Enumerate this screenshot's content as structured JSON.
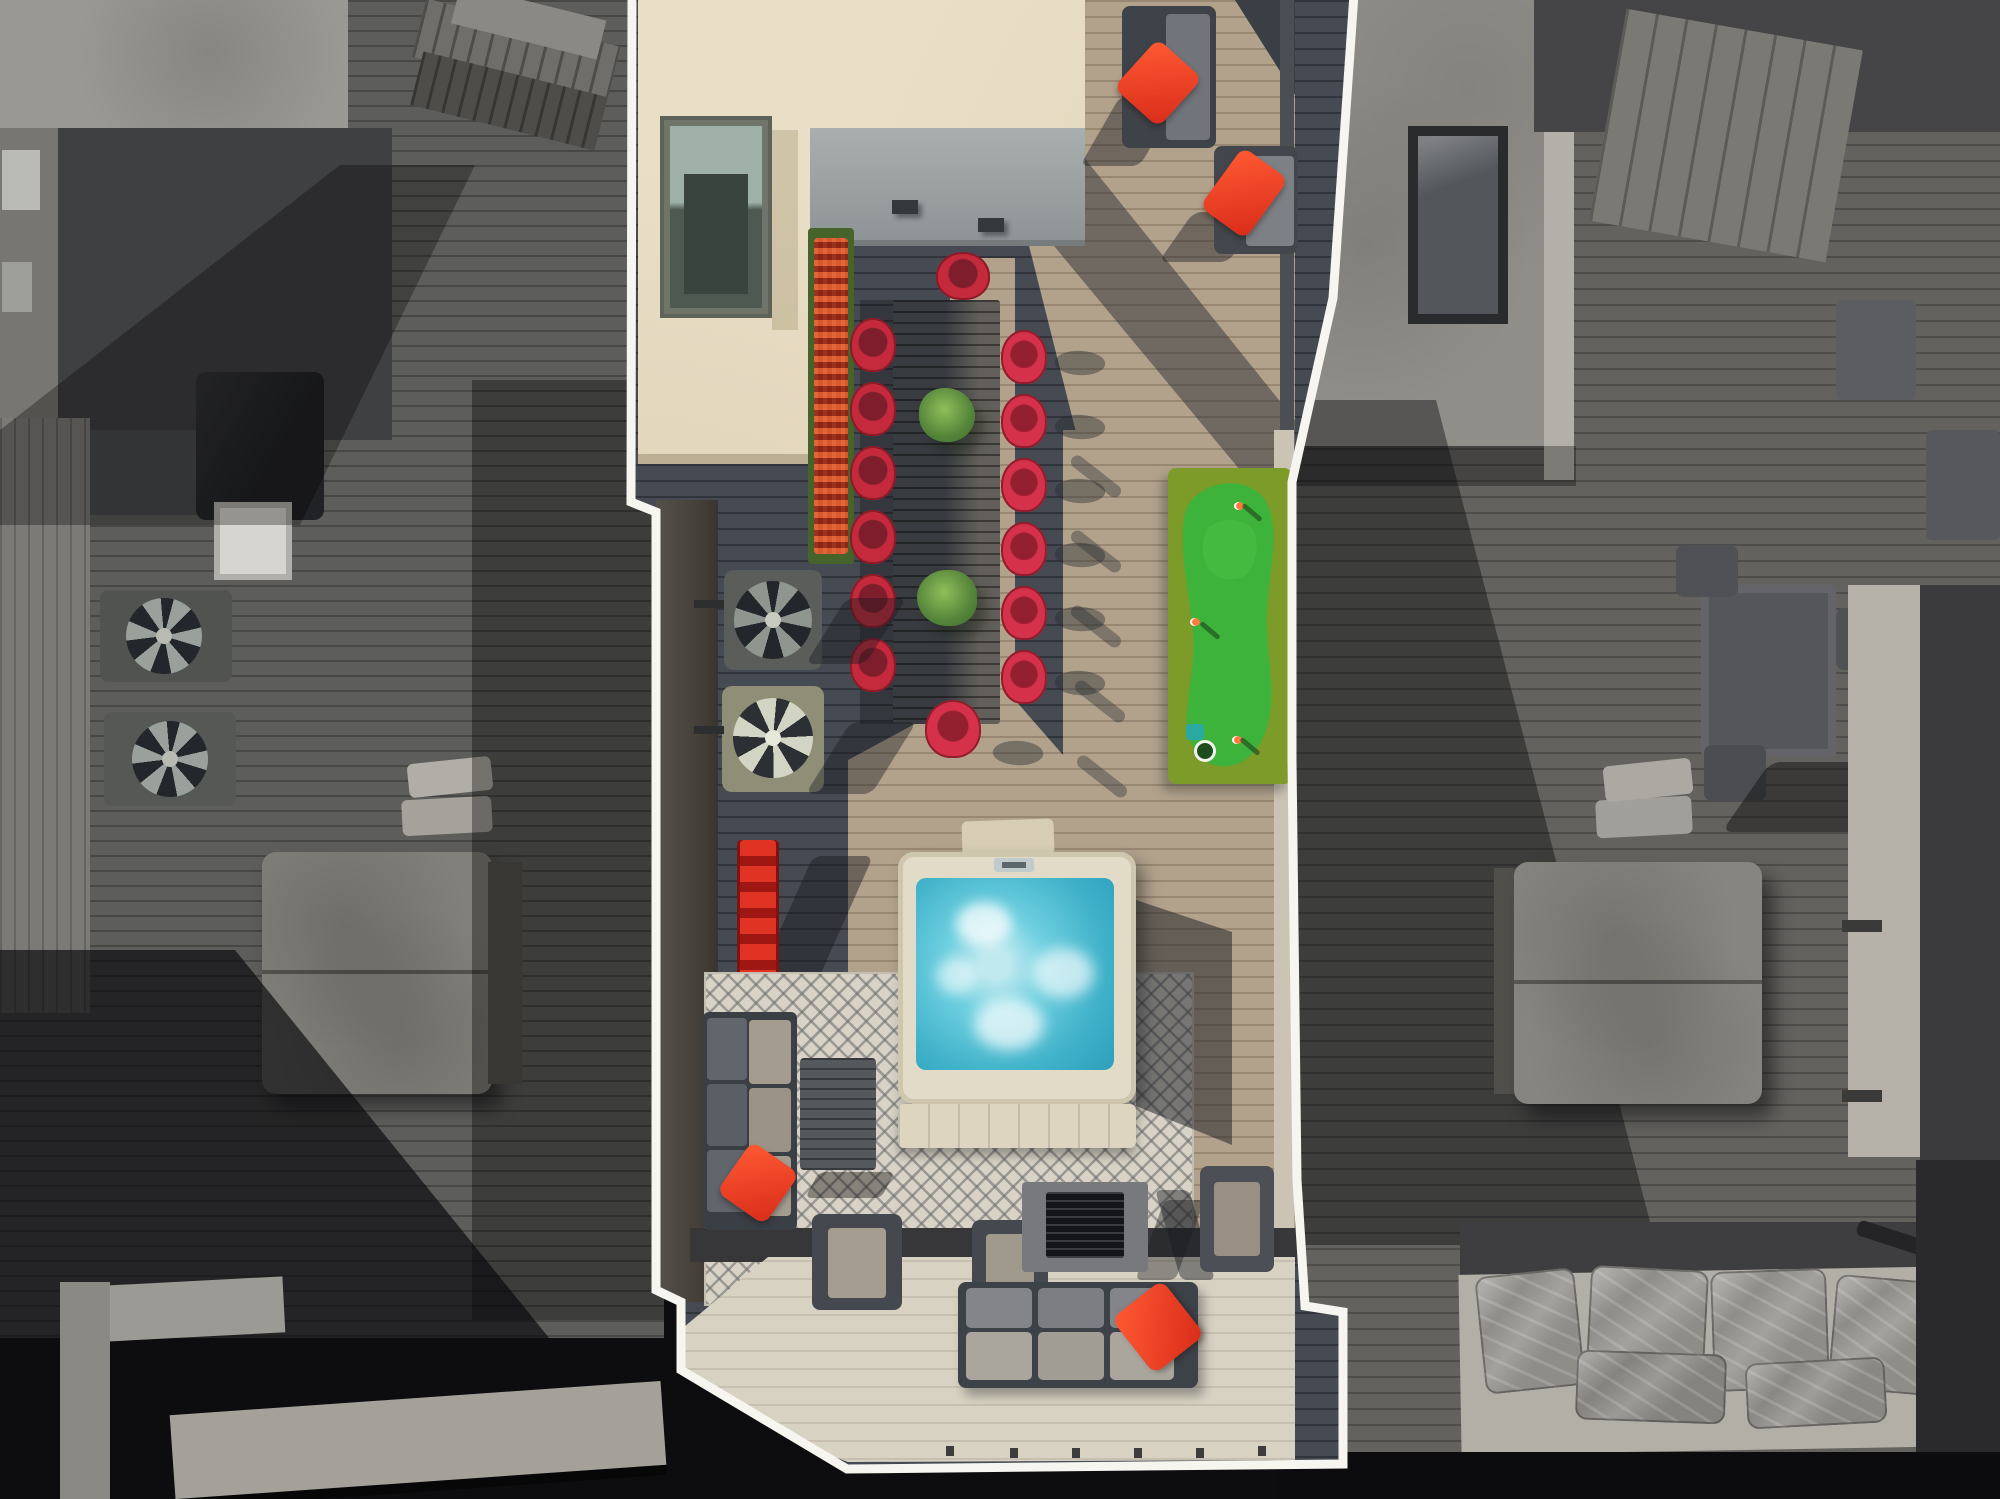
{
  "scene": {
    "type": "aerial-drone-photograph",
    "style": "selective-color real estate photo: subject rooftop deck in full color, neighboring rooftops desaturated to grayscale",
    "view": "top-down",
    "boundary_marker": "white outline traced around the subject rooftop property"
  },
  "palette": {
    "white_outline": "#f7f5f0",
    "cream_roof": "#e9dfc7",
    "deck_shadowed": "#464b53",
    "deck_sunlit_tan": "#b2a28c",
    "deck_pale_platform": "#d8d2c3",
    "accent_red_pillow": "#e8402a",
    "chair_red": "#c42a3c",
    "putting_green_bright": "#3eb33b",
    "putting_green_border": "#7d9b28",
    "hot_tub_water": "#58c3d8",
    "hot_tub_shell": "#e2dbc8",
    "rug_base": "#d8d3c6",
    "grayscale_deck": "#5d5d5b",
    "grayscale_black": "#0d0d0f"
  },
  "subject_property": {
    "features": [
      "penthouse roof with skylight",
      "flower planter with red blooms",
      "long dining table with fourteen red shell chairs and two plant centerpieces",
      "artificial turf putting green with three flags and a cup",
      "two HVAC condenser fan units",
      "red storage rack",
      "square hot tub with bubbling turquoise water and folded tan cover",
      "geometric patterned outdoor rug",
      "gray sectional sofa with red accent pillow",
      "slatted coffee table",
      "fire pit table with black burner insert",
      "three lounge armchairs",
      "three-seat sofa with red accent pillow on pale lower terrace",
      "two corner lounge seats with red pillows at the top terrace"
    ]
  },
  "neighbor_left": {
    "features": [
      "grayscale penthouse roof structure",
      "stacked wooden pallets",
      "covered grill",
      "utility box",
      "two HVAC condenser fans",
      "covered hot tub with folded pads",
      "palm plant",
      "light parapet curbs at bottom"
    ]
  },
  "neighbor_right": {
    "features": [
      "grayscale concrete roof with skylight box",
      "paneled roof section",
      "outdoor dining table with chairs",
      "covered hot tub with folded pads",
      "light vertical wall band",
      "plastic wrapped patio cushions on lower platform",
      "stair handrail"
    ]
  }
}
